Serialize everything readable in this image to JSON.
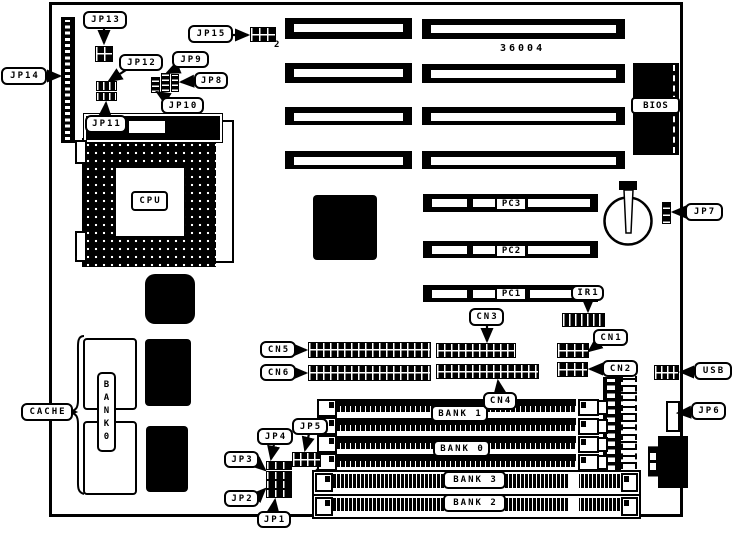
{
  "board": {
    "silkscreen_number": "36004"
  },
  "colors": {
    "ink": "#000000",
    "paper": "#ffffff"
  },
  "labels": {
    "jp1": "JP1",
    "jp2": "JP2",
    "jp3": "JP3",
    "jp4": "JP4",
    "jp5": "JP5",
    "jp6": "JP6",
    "jp7": "JP7",
    "jp8": "JP8",
    "jp9": "JP9",
    "jp10": "JP10",
    "jp11": "JP11",
    "jp12": "JP12",
    "jp13": "JP13",
    "jp14": "JP14",
    "jp15": "JP15",
    "cn1": "CN1",
    "cn2": "CN2",
    "cn3": "CN3",
    "cn4": "CN4",
    "cn5": "CN5",
    "cn6": "CN6",
    "pc1": "PC1",
    "pc2": "PC2",
    "pc3": "PC3",
    "ir1": "IR1",
    "usb": "USB",
    "jp15_pin2": "2",
    "jp5_pin2": "2"
  },
  "chips": {
    "cpu": "CPU",
    "bios": "BIOS",
    "cache": "CACHE",
    "cache_bank": "BANK0"
  },
  "memory": {
    "bank1": "BANK 1",
    "bank0": "BANK 0",
    "bank3": "BANK 3",
    "bank2": "BANK 2"
  }
}
